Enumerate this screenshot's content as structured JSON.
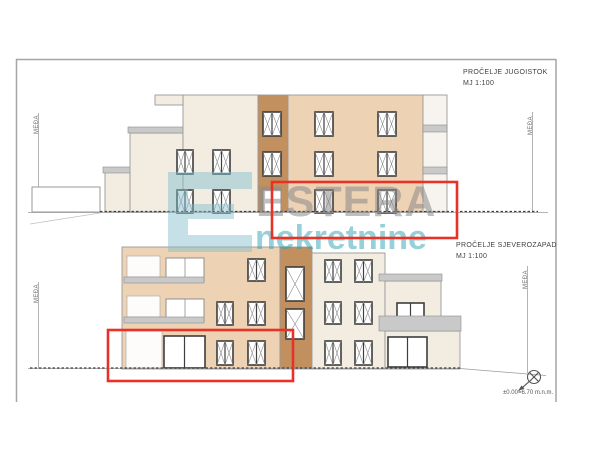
{
  "elevations": [
    {
      "title": "PROČELJE JUGOISTOK",
      "scale": "MJ 1:100"
    },
    {
      "title": "PROČELJE SJEVEROZAPAD",
      "scale": "MJ 1:100"
    }
  ],
  "labels": {
    "boundary": "MEĐA",
    "elevation_note": "±0.00=6.70 m.n.m."
  },
  "watermark": {
    "brand": "ESTERA",
    "subtitle": "nekretnine",
    "logo": "estera-e-logo"
  },
  "highlights": {
    "count": 2,
    "description_color": "#e73327"
  },
  "colors": {
    "facade_cream": "#f2ece1",
    "facade_tan": "#eed2b4",
    "facade_brown": "#c2905f",
    "facade_white": "#f7f4ef",
    "band_gray": "#c9c9c9",
    "band_stroke": "#8e8e8e",
    "frame_dark": "#3d3d3d",
    "line_mid": "#8f8f8f",
    "line_gray": "#9a9a9a",
    "ground_dark": "#3f3f3f",
    "highlight_red": "#e73327",
    "wm_gray": "#8b8b8b",
    "wm_teal": "#2fa3b4",
    "wm_logo": "#7fbccc"
  }
}
